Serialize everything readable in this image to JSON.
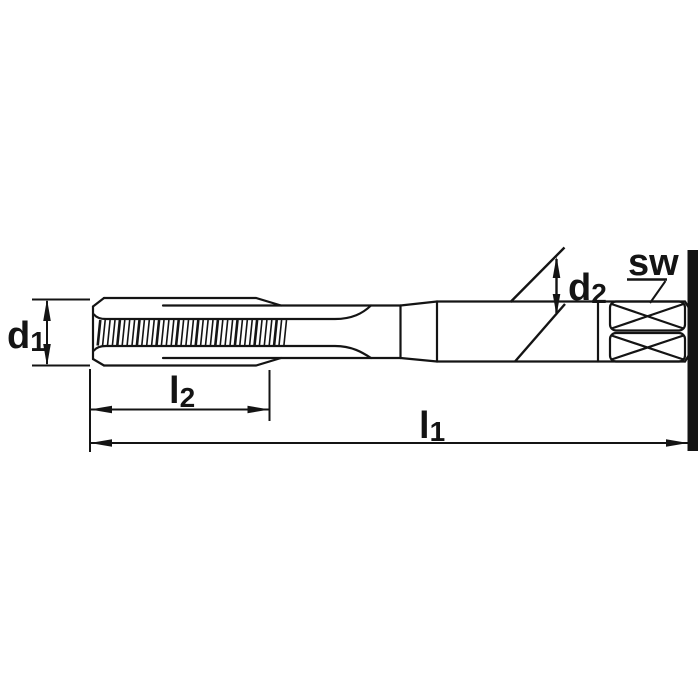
{
  "page": {
    "background": "#ffffff"
  },
  "diagram": {
    "type": "technical-line-drawing",
    "subject": "hand-tap-side-view-with-square-drive",
    "line_color": "#141414",
    "labels": {
      "d1": {
        "main": "d",
        "sub": "1"
      },
      "d2": {
        "main": "d",
        "sub": "2"
      },
      "l1": {
        "main": "l",
        "sub": "1"
      },
      "l2": {
        "main": "l",
        "sub": "2"
      },
      "sw": "sw"
    }
  }
}
